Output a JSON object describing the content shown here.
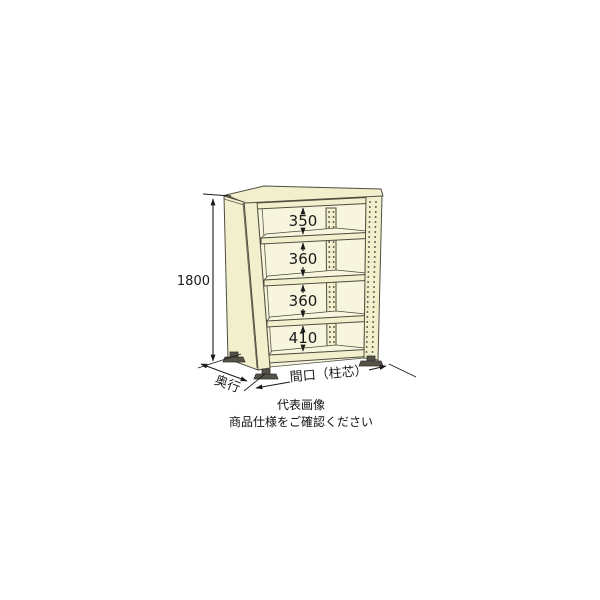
{
  "product_diagram": {
    "type": "steel-shelving-rack-dimension-drawing",
    "height_dimension_label": "1800",
    "shelf_gap_labels": [
      "350",
      "360",
      "360",
      "410"
    ],
    "depth_label": "奥行",
    "width_label": "間口（柱芯）",
    "shelf_count": 5,
    "colors": {
      "background": "#ffffff",
      "body_fill": "#f2f0cc",
      "body_light": "#f7f5dd",
      "outline": "#4f4e40",
      "foot": "#55524a",
      "dimension_text": "#1a1a1a"
    }
  },
  "caption": {
    "line1": "代表画像",
    "line2": "商品仕様をご確認ください"
  }
}
